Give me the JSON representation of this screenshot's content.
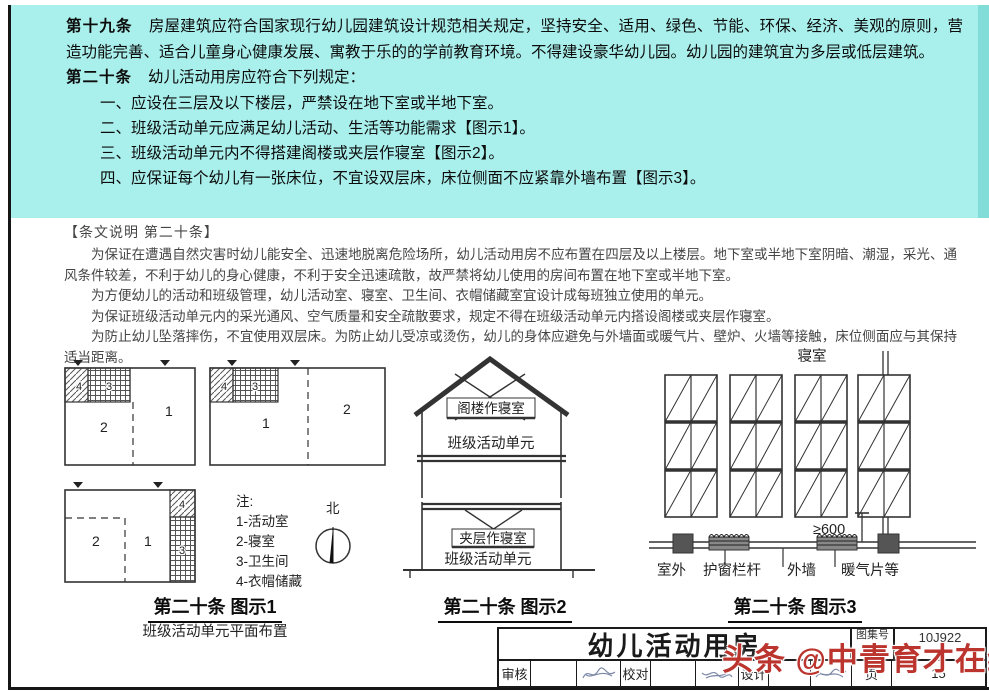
{
  "regulations": {
    "article19": {
      "label": "第十九条",
      "text": "房屋建筑应符合国家现行幼儿园建筑设计规范相关规定，坚持安全、适用、绿色、节能、环保、经济、美观的原则，营造功能完善、适合儿童身心健康发展、寓教于乐的的学前教育环境。不得建设豪华幼儿园。幼儿园的建筑宜为多层或低层建筑。"
    },
    "article20": {
      "label": "第二十条",
      "text": "幼儿活动用房应符合下列规定："
    },
    "items": [
      "一、应设在三层及以下楼层，严禁设在地下室或半地下室。",
      "二、班级活动单元应满足幼儿活动、生活等功能需求【图示1】。",
      "三、班级活动单元内不得搭建阁楼或夹层作寝室【图示2】。",
      "四、应保证每个幼儿有一张床位，不宜设双层床，床位侧面不应紧靠外墙布置【图示3】。"
    ]
  },
  "commentary": {
    "heading": "【条文说明 第二十条】",
    "paragraphs": [
      "为保证在遭遇自然灾害时幼儿能安全、迅速地脱离危险场所，幼儿活动用房不应布置在四层及以上楼层。地下室或半地下室阴暗、潮湿，采光、通风条件较差，不利于幼儿的身心健康，不利于安全迅速疏散，故严禁将幼儿使用的房间布置在地下室或半地下室。",
      "为方便幼儿的活动和班级管理，幼儿活动室、寝室、卫生间、衣帽储藏室宜设计成每班独立使用的单元。",
      "为保证班级活动单元内的采光通风、空气质量和安全疏散要求，规定不得在班级活动单元内搭设阁楼或夹层作寝室。",
      "为防止幼儿坠落摔伤，不宜使用双层床。为防止幼儿受凉或烫伤，幼儿的身体应避免与外墙面或暖气片、壁炉、火墙等接触，床位侧面应与其保持适当距离。"
    ]
  },
  "figure1": {
    "rooms": {
      "r1": "1",
      "r2": "2",
      "r3": "3",
      "r4": "4"
    },
    "notes_title": "注:",
    "notes": [
      "1-活动室",
      "2-寝室",
      "3-卫生间",
      "4-衣帽储藏"
    ],
    "north_label": "北",
    "caption": "第二十条 图示1",
    "subcaption": "班级活动单元平面布置"
  },
  "figure2": {
    "attic_label": "阁楼作寝室",
    "unit_label_top": "班级活动单元",
    "mezzanine_label": "夹层作寝室",
    "unit_label_bottom": "班级活动单元",
    "caption": "第二十条 图示2"
  },
  "figure3": {
    "bedroom_label": "寝室",
    "dimension": "≥600",
    "outdoor_label": "室外",
    "guardrail_label": "护窗栏杆",
    "wall_label": "外墙",
    "radiator_label": "暖气片等",
    "caption": "第二十条 图示3"
  },
  "titleblock": {
    "title": "幼儿活动用房",
    "atlas_label": "图集号",
    "atlas_number": "10J922",
    "page_label": "页",
    "page_number": "15",
    "reviewer_label": "审核",
    "reviewer_name": "马晓东",
    "checker_label": "校对",
    "checker_name": "谭亮",
    "designer_label": "设计",
    "designer_name": "孟媛"
  },
  "watermark": {
    "text": "头条 @中青育才在线",
    "color": "#bc342e"
  }
}
